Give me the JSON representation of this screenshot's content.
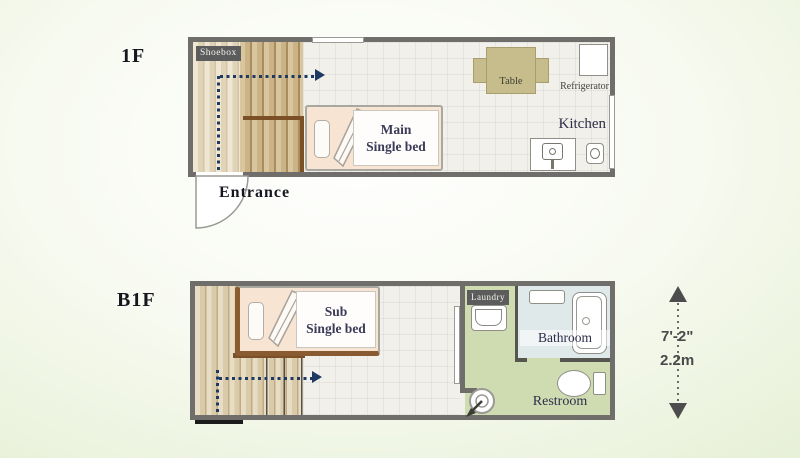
{
  "f1": {
    "floor_label": "1F",
    "shoebox": "Shoebox",
    "table": "Table",
    "refrigerator": "Refrigerator",
    "kitchen": "Kitchen",
    "bed": {
      "line1": "Main",
      "line2": "Single bed"
    },
    "entrance": "Entrance"
  },
  "b1f": {
    "floor_label": "B1F",
    "bed": {
      "line1": "Sub",
      "line2": "Single bed"
    },
    "laundry": "Laundry",
    "bathroom": "Bathroom",
    "restroom": "Restroom"
  },
  "dimension": {
    "imperial": "7'-2\"",
    "metric": "2.2m"
  },
  "colors": {
    "wall": "#6f6e6a",
    "wood": "#cbb385",
    "bed_fill": "#f8e4d3",
    "route_arrow": "#1e3a63",
    "green_floor": "#cfdcb2",
    "bathroom_floor": "#e0e9ea",
    "table": "#c6bc8c",
    "dark_label_bg": "#5c5c5c",
    "room_text": "#2e2e4a",
    "dimension_text": "#4a4a4a"
  }
}
